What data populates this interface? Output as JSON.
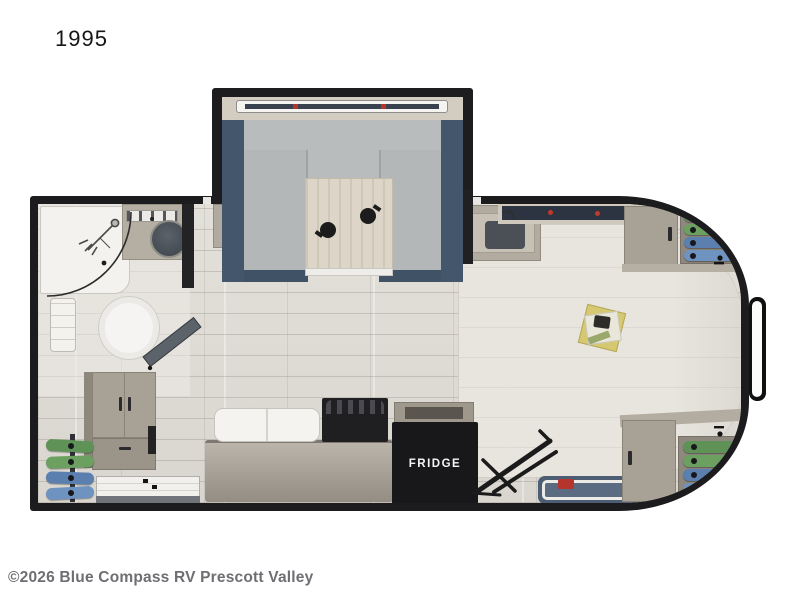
{
  "plan": {
    "model_label": "1995",
    "watermark": "©2026 Blue Compass RV Prescott Valley"
  },
  "appliances": {
    "fridge_label": "FRIDGE"
  },
  "colors": {
    "wall_black": "#1c1c1e",
    "slide_navy": "#44566b",
    "dinette_gray": "#b9bcbd",
    "table_wood": "#ddd6c8",
    "floor_wood": "#e0ddd6",
    "cabinet_tan": "#a8a196",
    "bed_cream": "#e8e5de",
    "clothes_green_1": "#5f9257",
    "clothes_green_2": "#6ba061",
    "clothes_blue_1": "#5b7fae",
    "clothes_blue_2": "#6f93c0",
    "knob_red": "#b5342c",
    "tray_navy": "#4d5d73"
  }
}
